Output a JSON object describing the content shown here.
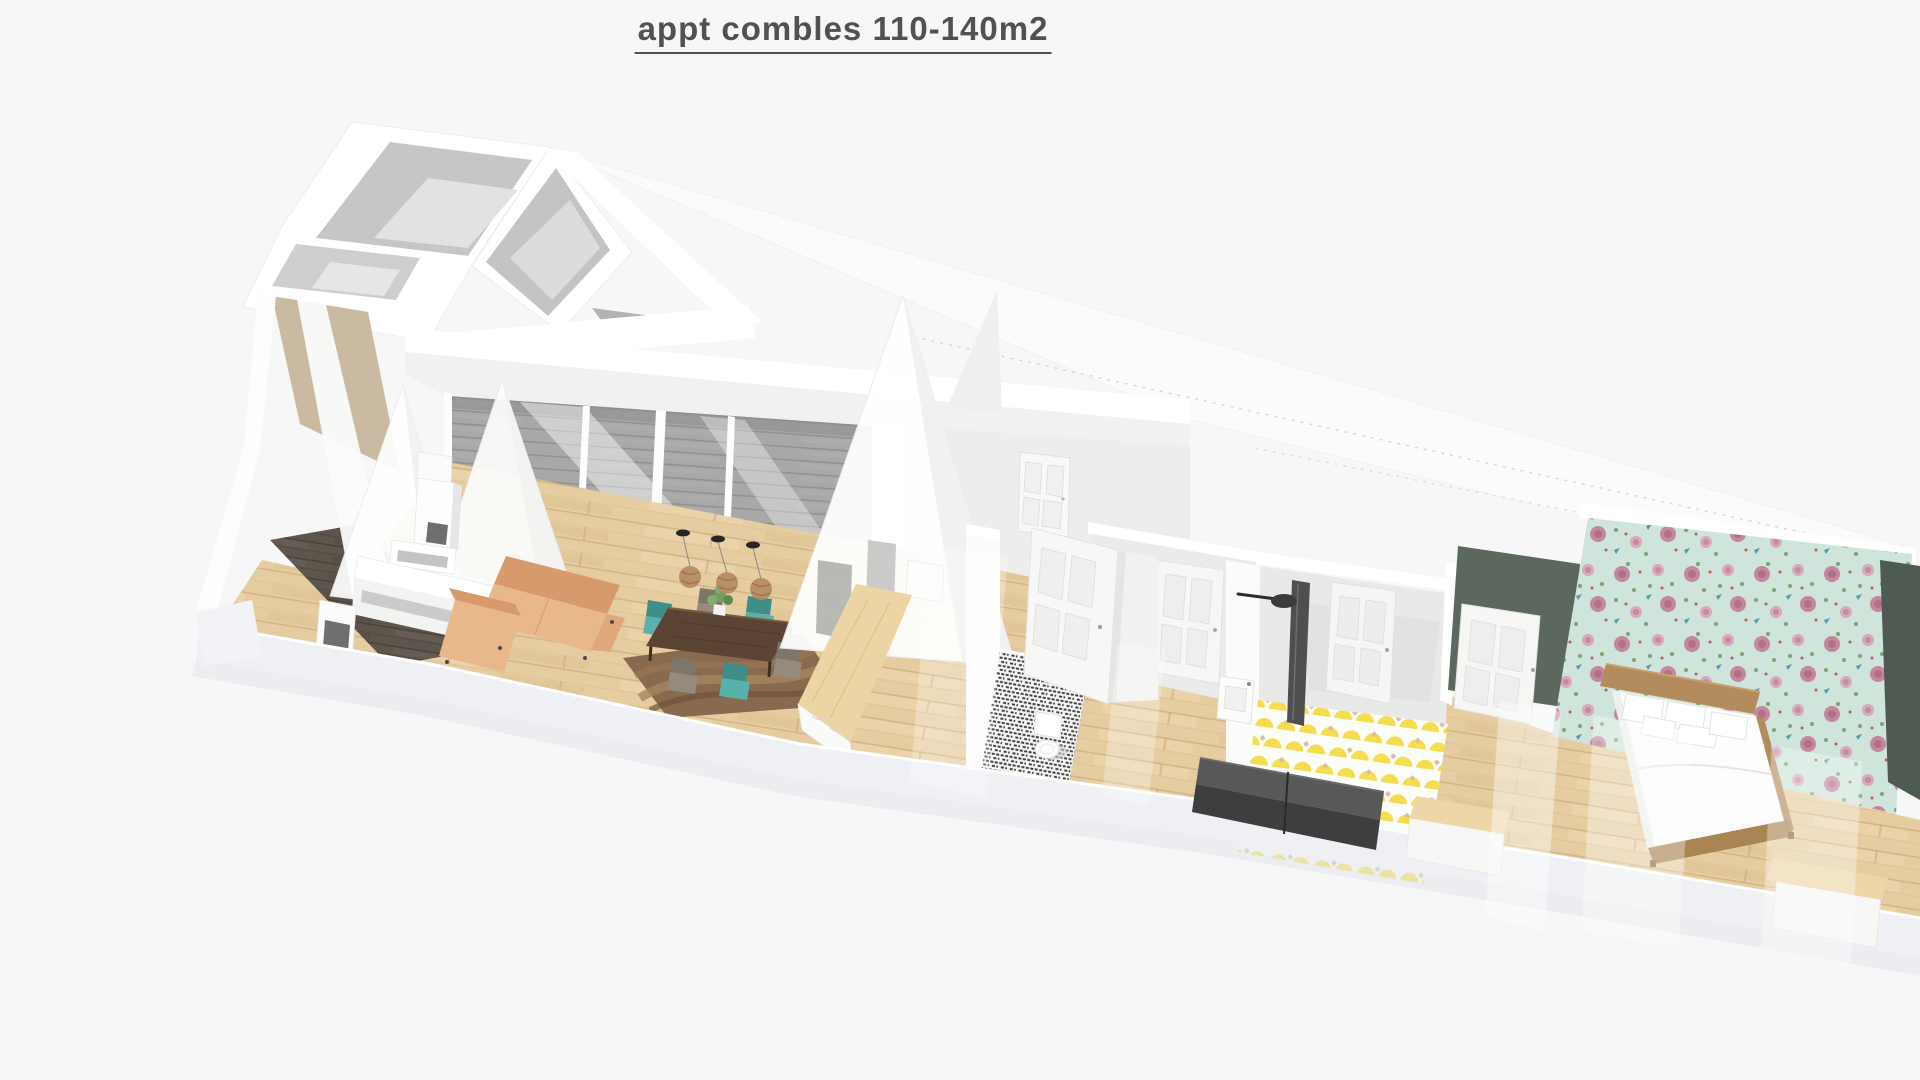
{
  "page": {
    "title": "appt combles 110-140m2"
  },
  "colors": {
    "background": "#f7f7f8",
    "title_text": "#515151",
    "cut_wall_band": "#eef0f4",
    "wall_white": "#ffffff",
    "wall_gray": "#c6c6c6",
    "gable_beige": "#c9baa1",
    "terrace_deck": "#a8a8a6",
    "floor_wood": "#e6cda1",
    "floor_entry_dark": "#5d564d",
    "sofa_leather": "#e8b88b",
    "sofa_leather_dark": "#d79a6c",
    "rug_brown": "#8a6a4e",
    "dining_table_wood": "#5c4434",
    "chair_teal": "#58b1aa",
    "chair_gray": "#948b7d",
    "kitchen_island_wood": "#ecd4a4",
    "pendant_shade": "#b58a63",
    "wc_mosaic_dark": "#383838",
    "bathroom_tile_yellow": "#f4de4d",
    "bathroom_tile_tan": "#d9bfa0",
    "vanity_dark": "#3e3e3e",
    "vanity_top": "#585858",
    "bedroom_wall_green": "#5c675d",
    "bedroom_wall_green_dark": "#4f5a52",
    "wallpaper_mint": "#cfe4db",
    "wallpaper_rose": "#c4879d",
    "wallpaper_bird_blue": "#4f9bab",
    "bed_frame_wood": "#b28c5c",
    "bench_wood_top": "#eed6a8"
  }
}
